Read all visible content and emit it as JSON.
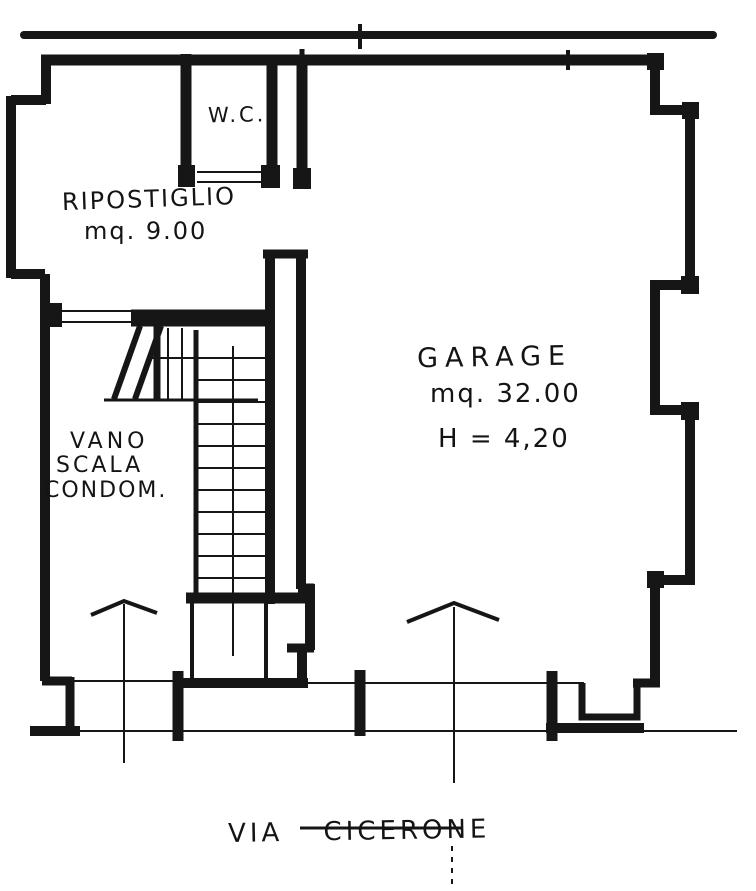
{
  "colors": {
    "ink": "#161616",
    "paper": "#ffffff"
  },
  "rooms": {
    "wc": {
      "label": "W.C."
    },
    "ripostiglio": {
      "label": "RIPOSTIGLIO",
      "area": "mq. 9.00"
    },
    "garage": {
      "label": "GARAGE",
      "area": "mq. 32.00",
      "height": "H = 4,20"
    },
    "vano_scala": {
      "line1": "VANO",
      "line2": "SCALA",
      "line3": "CONDOM."
    }
  },
  "street": {
    "label": "VIA CICERONE"
  }
}
